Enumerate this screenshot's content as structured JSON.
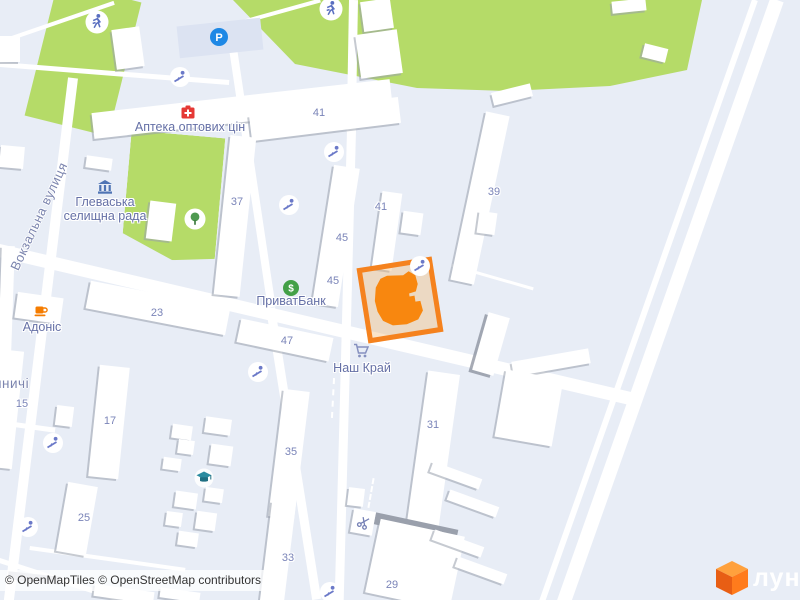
{
  "map": {
    "attribution": "© OpenMapTiles © OpenStreetMap contributors",
    "logo_text": "лун",
    "street_label": "Вокзальна вулиця",
    "place_label": "иничі",
    "pois": {
      "pharmacy": {
        "name": "Аптека оптових цін",
        "icon": "pharmacy-icon",
        "color": "#E53935"
      },
      "townhall": {
        "line1": "Глеваська",
        "line2": "селищна рада",
        "icon": "townhall-icon",
        "color": "#4F74B4"
      },
      "bank": {
        "name": "ПриватБанк",
        "symbol": "$",
        "icon": "bank-icon",
        "color": "#43A047"
      },
      "cafe": {
        "name": "Адоніс",
        "icon": "cafe-icon",
        "color": "#F57C00"
      },
      "supermarket": {
        "name": "Наш Край",
        "icon": "cart-icon"
      },
      "parking": {
        "symbol": "P",
        "icon": "parking-icon",
        "color": "#1E88E5"
      },
      "school": {
        "icon": "school-icon",
        "color": "#2B8BA0"
      },
      "hairdresser": {
        "icon": "scissors-icon"
      },
      "tree": {
        "icon": "tree-icon"
      },
      "playground": {
        "icon": "playground-icon"
      },
      "sports_pitch": {
        "icon": "running-icon"
      }
    },
    "house_numbers": [
      "41",
      "41",
      "45",
      "45",
      "37",
      "39",
      "23",
      "47",
      "15",
      "17",
      "25",
      "35",
      "33",
      "31",
      "29"
    ],
    "selected_plot": {
      "border_color": "#F5821E",
      "fill_color": "#F6DDBC",
      "building_color": "#F8870F"
    },
    "colors": {
      "background": "#E8EDF6",
      "green": "#B5DB68",
      "road": "#FFFFFF",
      "building": "#FFFFFF",
      "shadow": "#AFB4C0",
      "number_label": "#7A84B8",
      "poi_label": "#6570A6"
    }
  }
}
